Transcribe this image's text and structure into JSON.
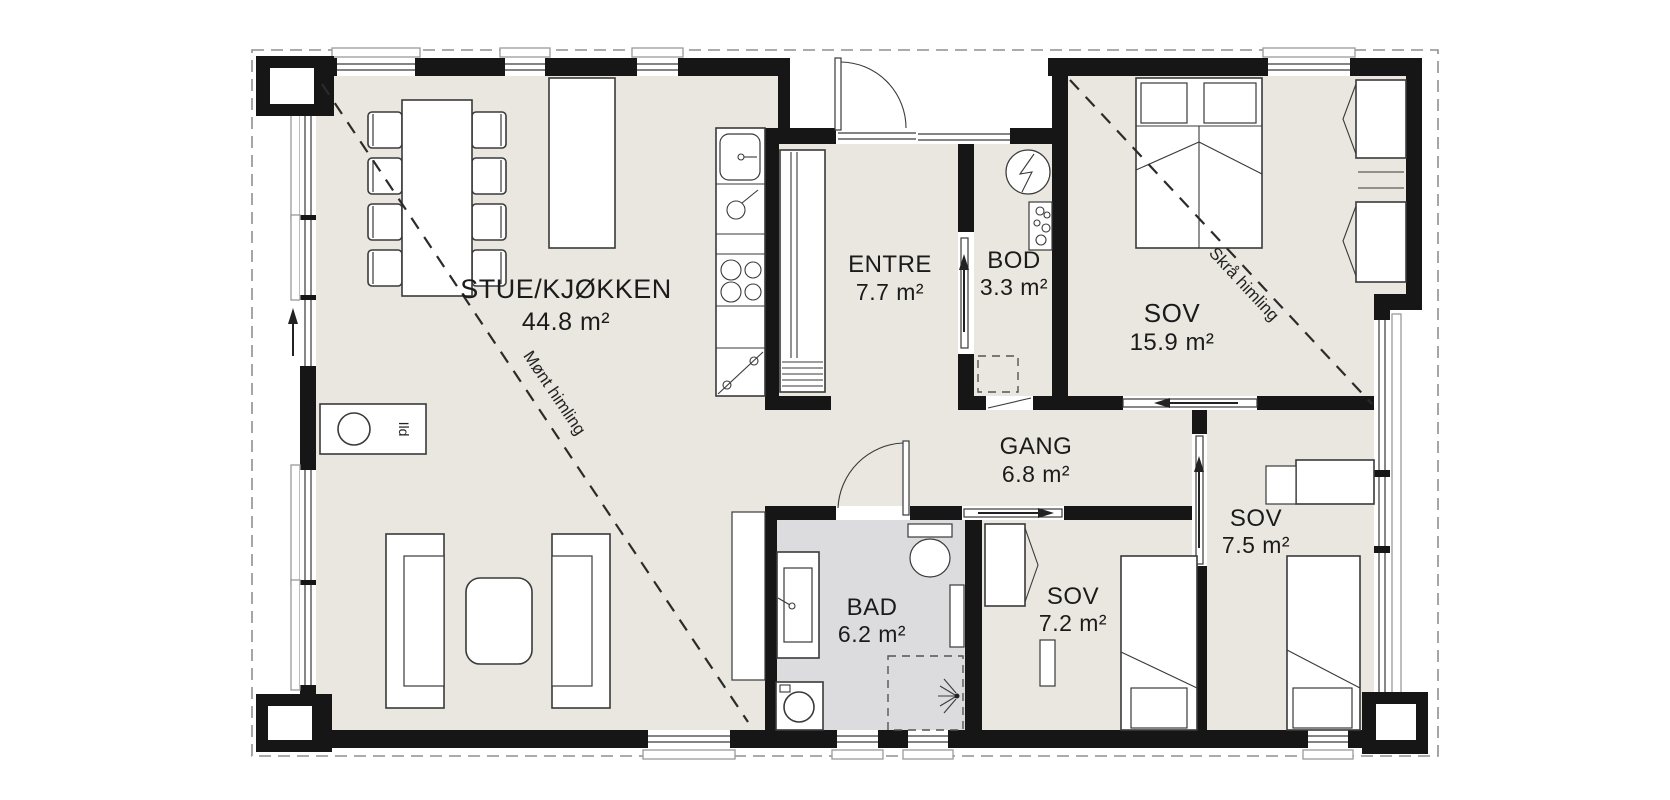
{
  "floorplan": {
    "rooms": [
      {
        "name": "STUE/KJØKKEN",
        "area": "44.8 m²"
      },
      {
        "name": "ENTRE",
        "area": "7.7 m²"
      },
      {
        "name": "BOD",
        "area": "3.3 m²"
      },
      {
        "name": "SOV",
        "area": "15.9 m²"
      },
      {
        "name": "GANG",
        "area": "6.8 m²"
      },
      {
        "name": "SOV",
        "area": "7.5 m²"
      },
      {
        "name": "SOV",
        "area": "7.2 m²"
      },
      {
        "name": "BAD",
        "area": "6.2 m²"
      }
    ],
    "ceiling_notes": {
      "ridge": "Mønt himling",
      "sloped": "Skrå himling"
    },
    "fireplace_label": "Ild",
    "colors": {
      "floor": "#e9e7df",
      "bathroom_floor": "#dcdcde",
      "wall": "#161616",
      "background": "#ffffff"
    }
  }
}
